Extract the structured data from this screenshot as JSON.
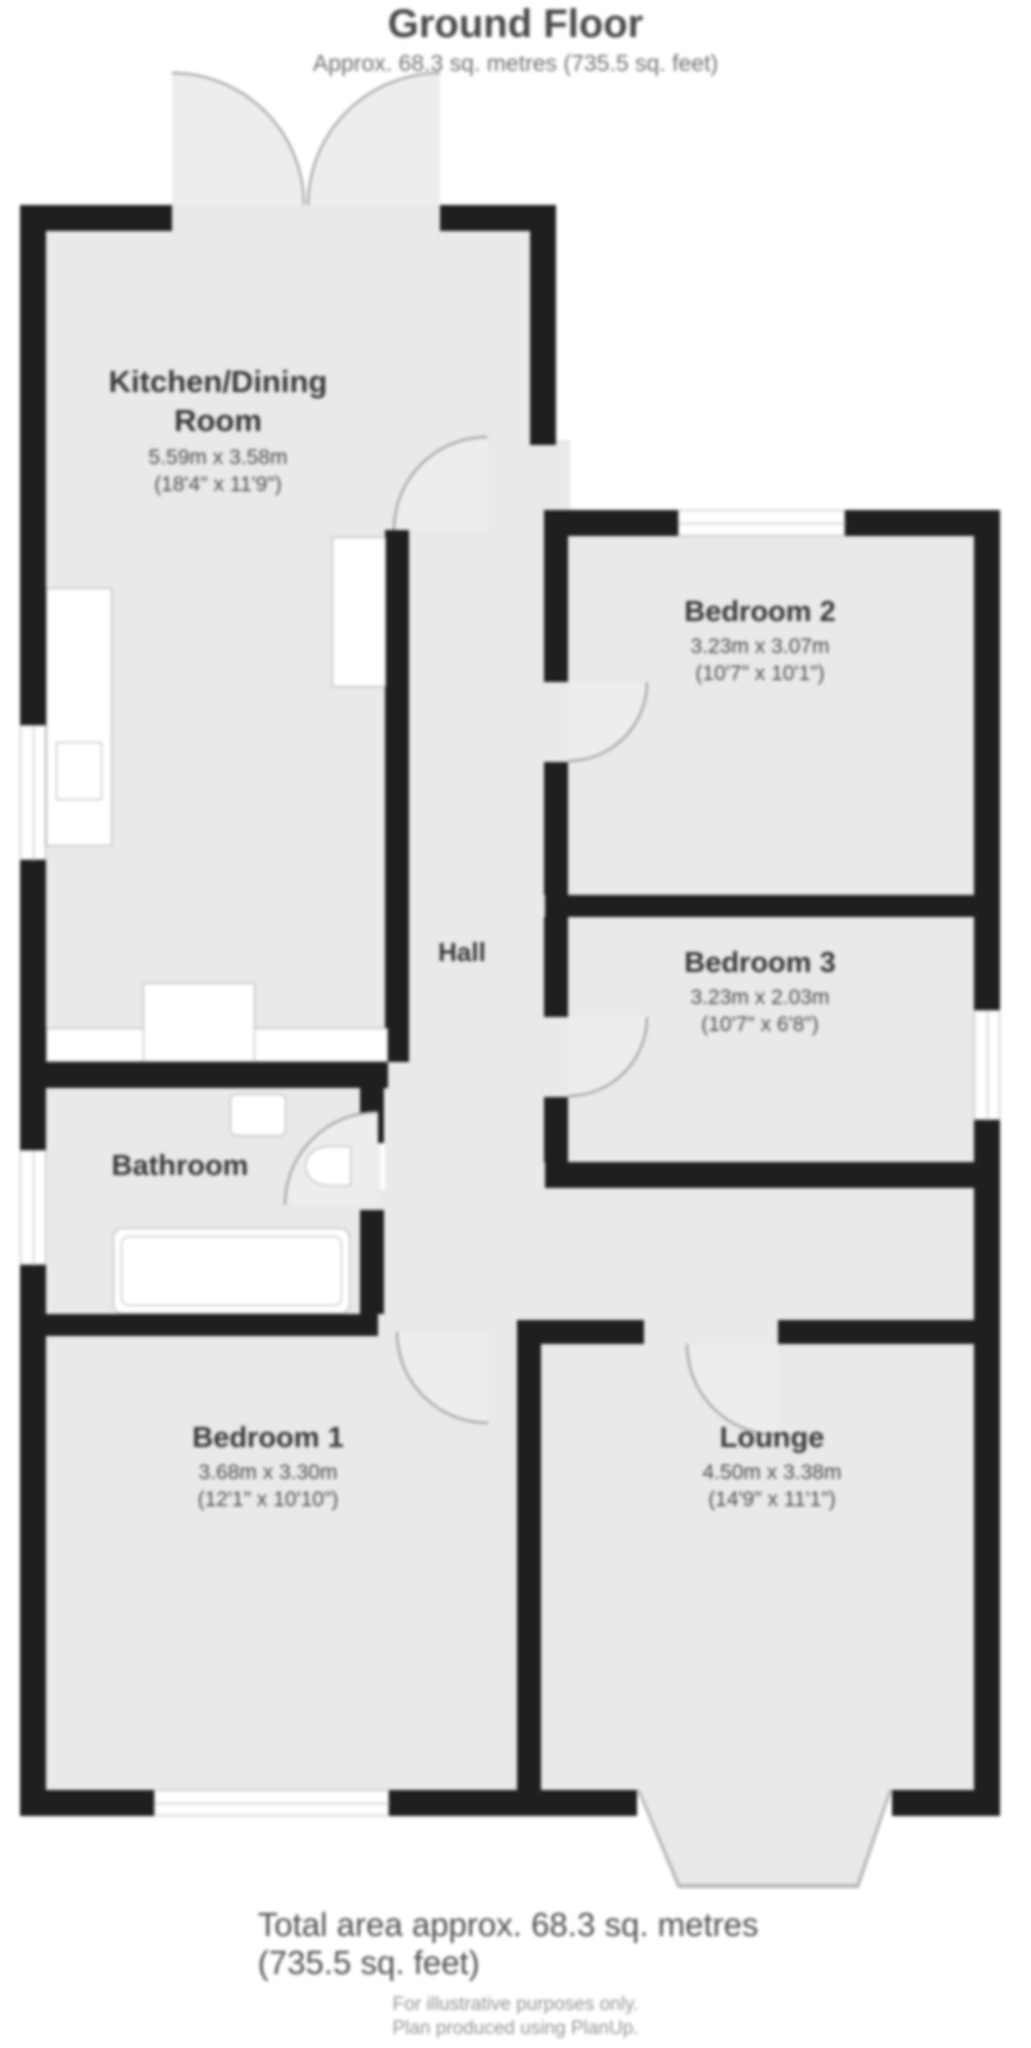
{
  "header": {
    "title": "Ground Floor",
    "subtitle": "Approx. 68.3 sq. metres (735.5 sq. feet)"
  },
  "rooms": [
    {
      "id": "kitchen-dining-room",
      "name_line1": "Kitchen/Dining",
      "name_line2": "Room",
      "dims_metric": "5.59m x 3.58m",
      "dims_imperial": "(18'4\" x 11'9\")"
    },
    {
      "id": "bedroom-2",
      "name": "Bedroom 2",
      "dims_metric": "3.23m x 3.07m",
      "dims_imperial": "(10'7\" x 10'1\")"
    },
    {
      "id": "bedroom-3",
      "name": "Bedroom 3",
      "dims_metric": "3.23m x 2.03m",
      "dims_imperial": "(10'7\" x 6'8\")"
    },
    {
      "id": "hall",
      "name": "Hall"
    },
    {
      "id": "bathroom",
      "name": "Bathroom"
    },
    {
      "id": "bedroom-1",
      "name": "Bedroom 1",
      "dims_metric": "3.68m x 3.30m",
      "dims_imperial": "(12'1\" x 10'10\")"
    },
    {
      "id": "lounge",
      "name": "Lounge",
      "dims_metric": "4.50m x 3.38m",
      "dims_imperial": "(14'9\" x 11'1\")"
    }
  ],
  "footer": {
    "total_area": "Total area approx. 68.3 sq. metres (735.5 sq. feet)",
    "line1": "For illustrative purposes only.",
    "line2": "Plan produced using PlanUp."
  },
  "colors": {
    "wall": "#1f1f1f",
    "floor": "#e9e9e9",
    "background": "#ffffff",
    "text_dark": "#383838",
    "text_gray": "#6f6f6f"
  }
}
